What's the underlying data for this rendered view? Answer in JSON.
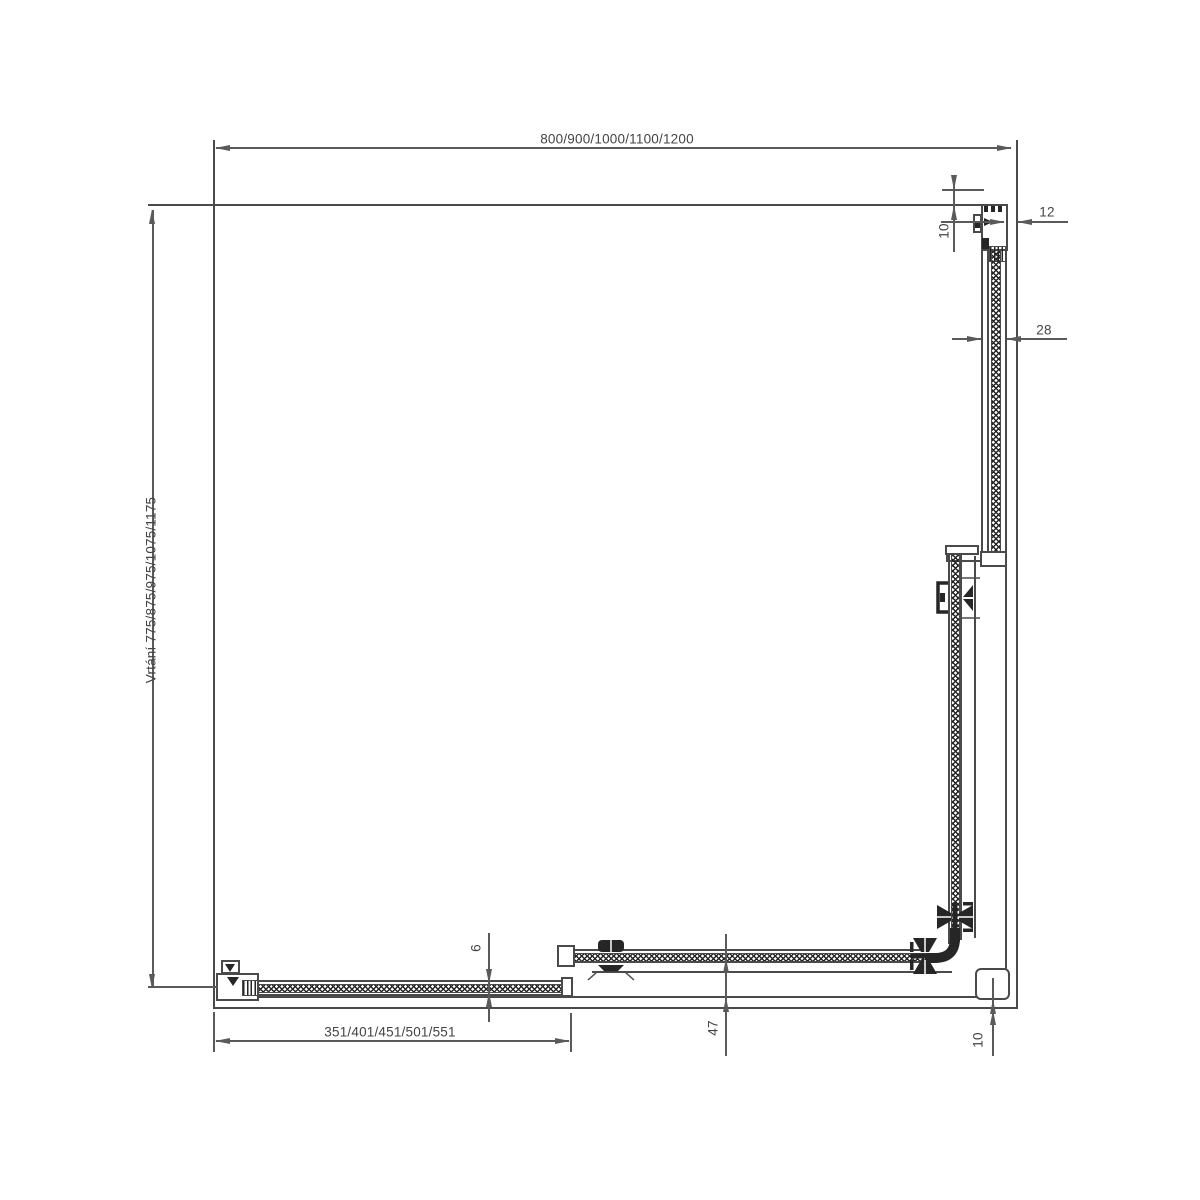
{
  "dimensions": {
    "overall_width": "800/900/1000/1100/1200",
    "drilling_height": "Vrtání 775/875/975/1075/1175",
    "door_glass_width": "351/401/451/501/551",
    "wall_gap": "12",
    "top_offset": "10",
    "panel_unit_depth": "28",
    "fixed_glass_thickness": "6",
    "rail_offset": "47",
    "bottom_gap": "10"
  },
  "colors": {
    "line": "#4a4a4a",
    "dim": "#5a5a5a",
    "dark": "#262626",
    "text": "#444444",
    "background": "#ffffff"
  }
}
